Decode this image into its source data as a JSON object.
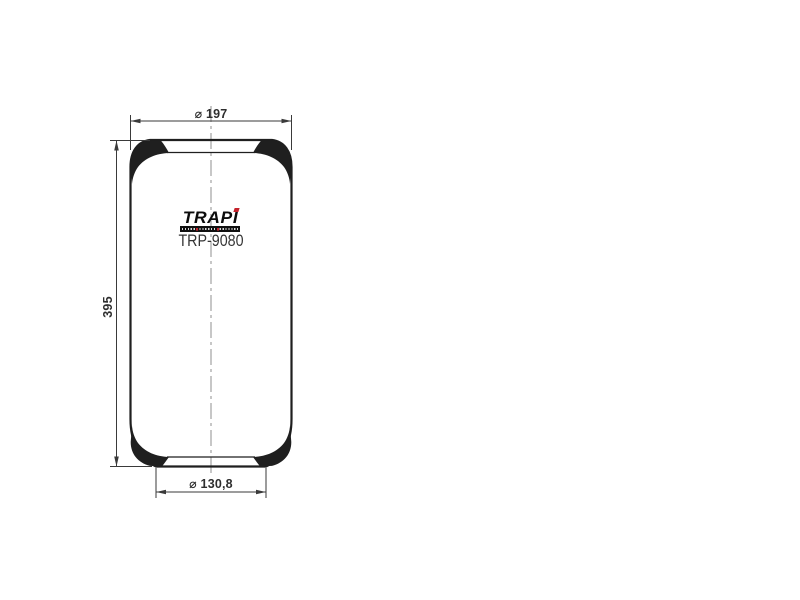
{
  "canvas": {
    "width": 800,
    "height": 600,
    "background": "#ffffff"
  },
  "drawing_kind": "dimensioned outline drawing",
  "logo": {
    "brand": "TRAPI"
  },
  "part_number": "TRP-9080",
  "dimensions": {
    "top_diameter": {
      "label": "⌀ 197",
      "symbol": "⌀",
      "value": "197"
    },
    "height": {
      "label": "395",
      "value": "395"
    },
    "bottom_diameter": {
      "label": "⌀ 130,8",
      "symbol": "⌀",
      "value": "130,8"
    }
  },
  "colors": {
    "bg": "#ffffff",
    "outline": "#1f1f1f",
    "dim": "#3a3a3a",
    "centerline": "#8f8f8f",
    "label": "#2e2e2e",
    "part": "#353535",
    "accent": "#c4222b"
  }
}
